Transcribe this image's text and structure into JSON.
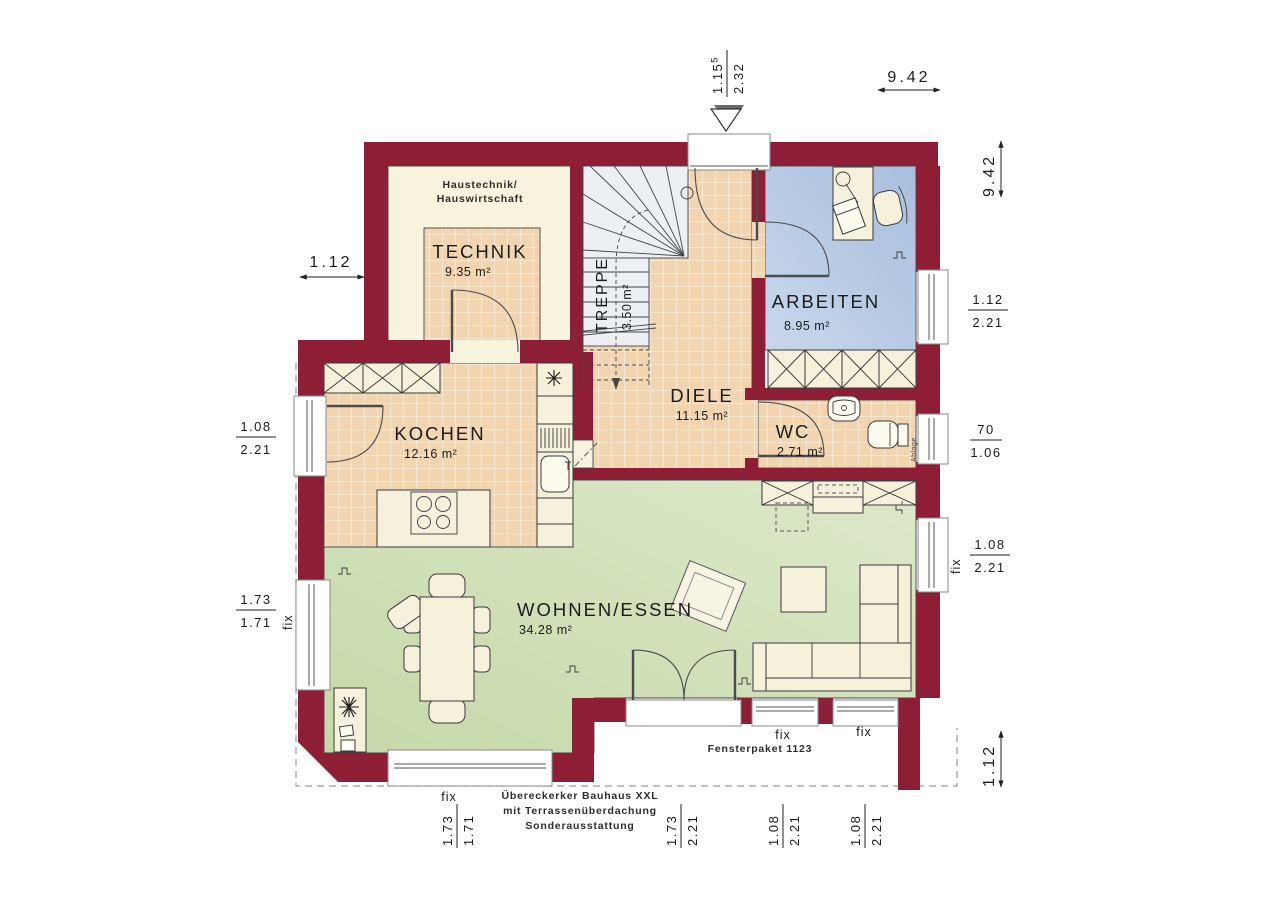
{
  "rooms": {
    "technik": {
      "name": "TECHNIK",
      "area": "9.35 m²"
    },
    "treppe": {
      "name": "TREPPE",
      "area": "3.50 m²"
    },
    "arbeiten": {
      "name": "ARBEITEN",
      "area": "8.95 m²"
    },
    "kochen": {
      "name": "KOCHEN",
      "area": "12.16 m²"
    },
    "diele": {
      "name": "DIELE",
      "area": "11.15 m²"
    },
    "wc": {
      "name": "WC",
      "area": "2.71 m²",
      "shelf_label": "Ablage"
    },
    "wohnen_essen": {
      "name": "WOHNEN/ESSEN",
      "area": "34.28 m²"
    }
  },
  "notes": {
    "technik_line1": "Haustechnik/",
    "technik_line2": "Hauswirtschaft",
    "bottom_line1": "Übereckerker Bauhaus XXL",
    "bottom_line2": "mit Terrassenüberdachung",
    "bottom_line3": "Sonderausstattung",
    "window_package": "Fensterpaket 1123"
  },
  "dimensions": {
    "entrance_width": "1.15",
    "entrance_width_sup": "5",
    "entrance_height": "2.32",
    "building_width": "9.42",
    "building_depth": "9.42",
    "left_offset": "1.12",
    "right_offset": "1.12",
    "arbeiten_window": {
      "w": "1.12",
      "h": "2.21"
    },
    "wc_window": {
      "w": "70",
      "h": "1.06"
    },
    "wohnen_right_window": {
      "label": "fix",
      "w": "1.08",
      "h": "2.21"
    },
    "kochen_window": {
      "w": "1.08",
      "h": "2.21"
    },
    "wohnen_left_window": {
      "label": "fix",
      "w": "1.73",
      "h": "1.71"
    },
    "bottom_window1": {
      "label": "fix",
      "w": "1.73",
      "h": "1.71"
    },
    "terrace_door": {
      "w": "1.73",
      "h": "2.21"
    },
    "bottom_window2": {
      "label": "fix",
      "w": "1.08",
      "h": "2.21"
    },
    "bottom_window3": {
      "label": "fix",
      "w": "1.08",
      "h": "2.21"
    }
  },
  "colors": {
    "wall": "#8e1e35",
    "tile": "#f1d4b0",
    "tile_grout": "#f9ecd9",
    "room_cream": "#f8f3dd",
    "arbeiten_blue": "#b3c7e1",
    "wohnen_green": "#cddcb0",
    "stair_gray": "#eceff4"
  }
}
